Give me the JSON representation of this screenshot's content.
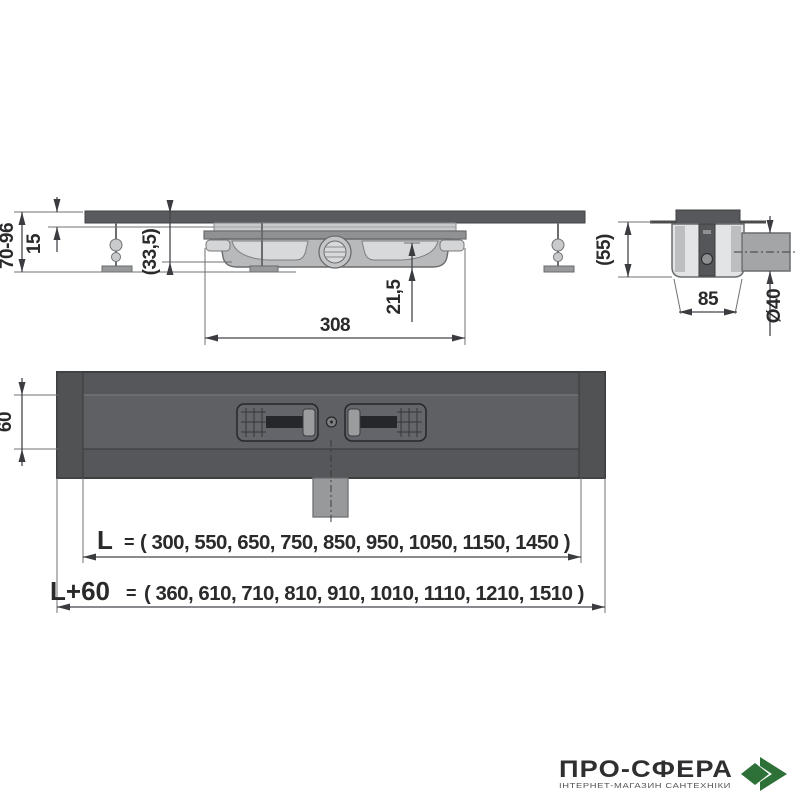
{
  "side_view": {
    "dim_height_range": "70-96",
    "dim_top_height": "15",
    "dim_inner_depth": "(33,5)",
    "dim_trap_depth": "21,5",
    "dim_body_length": "308"
  },
  "end_view": {
    "dim_height": "(55)",
    "dim_body_width": "85",
    "dim_outlet_diameter": "Ø40"
  },
  "top_view": {
    "dim_channel_width": "60"
  },
  "lengths": {
    "l_label": "L",
    "l_equals": "=",
    "l_values": "( 300, 550, 650, 750, 850, 950, 1050, 1150, 1450 )",
    "l60_label": "L+60",
    "l60_equals": "=",
    "l60_values": "( 360, 610, 710, 810, 910, 1010, 1110, 1210, 1510 )"
  },
  "watermark": {
    "wordmark": "ПРО-СФЕРА",
    "subtitle": "ІНТЕРНЕТ-МАГАЗИН САНТЕХНІКИ",
    "icon": "green-diamond-chevron-icon",
    "icon_color": "#2d7038"
  },
  "colors": {
    "channel_dark": "#57585a",
    "channel_mid": "#5e6063",
    "end_cap": "#505254",
    "light_part": "#c9cacc",
    "body_gray": "#b7b9bb",
    "dimension_line": "#45464a",
    "text": "#2a2a2c"
  }
}
